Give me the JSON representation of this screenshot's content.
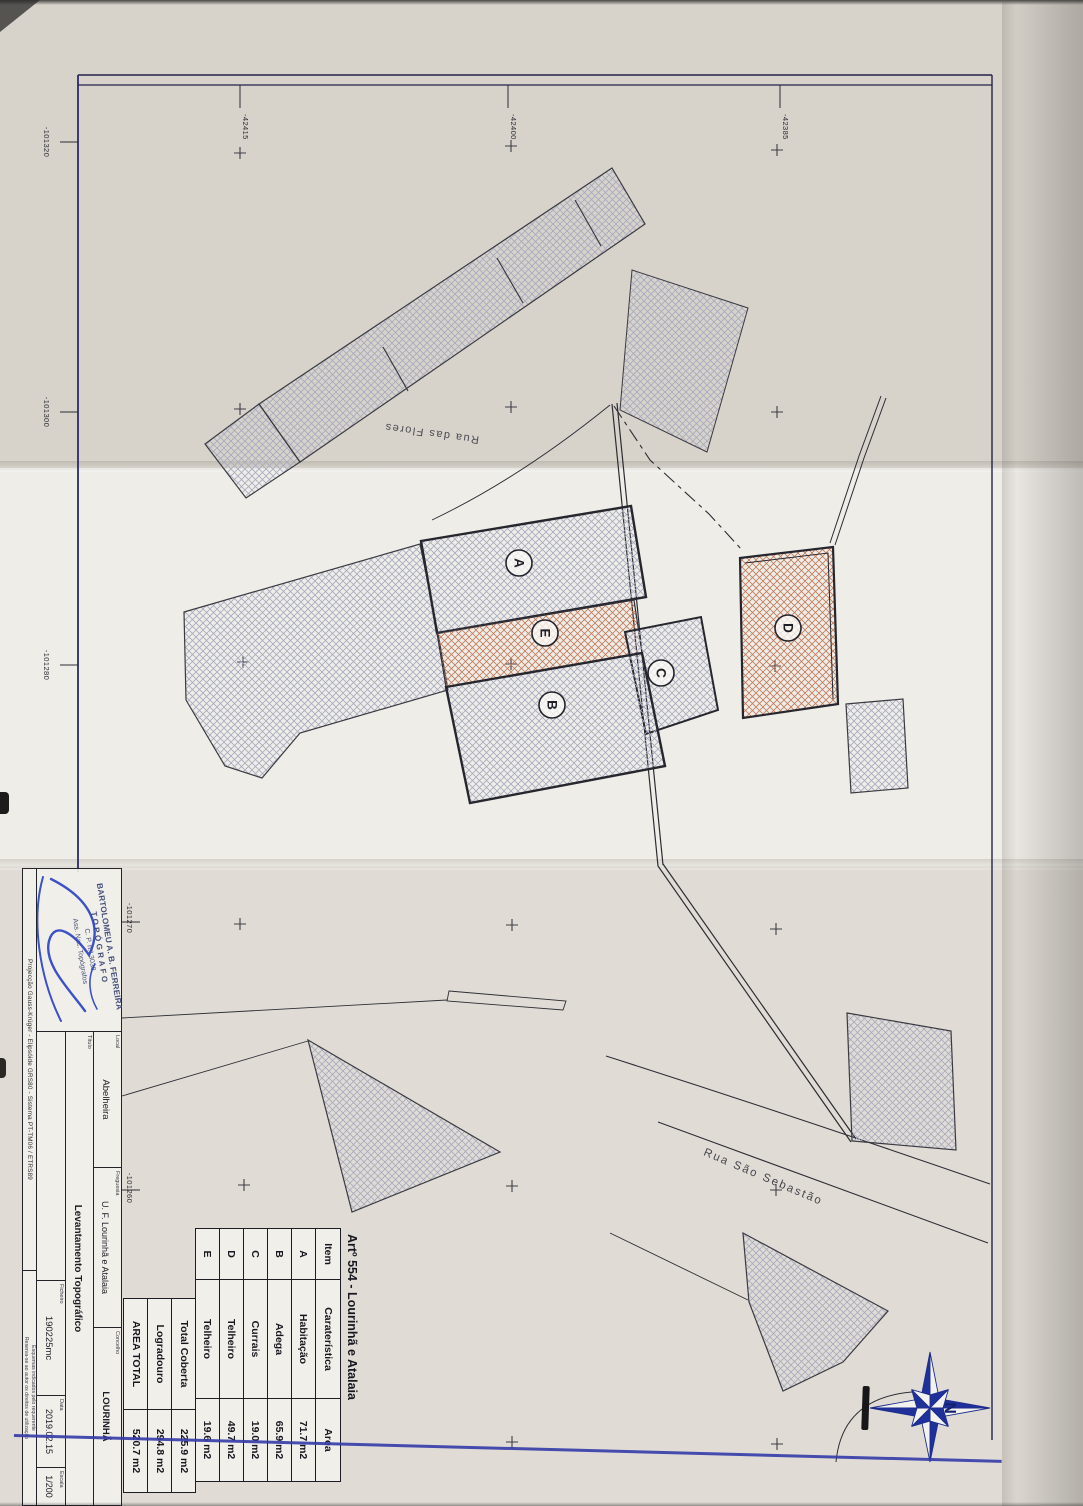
{
  "plan": {
    "title": "Artº 554 - Lourinhã e Atalaia",
    "streets": {
      "flores": "Rua das Flores",
      "sebastiao": "Rua São Sebastão"
    },
    "buildings": {
      "a": "A",
      "b": "B",
      "c": "C",
      "d": "D",
      "e": "E"
    },
    "grid": {
      "top": [
        "-42415",
        "-42400",
        "-42385"
      ],
      "left": [
        "-101320",
        "-101300",
        "-101280",
        "-101270",
        "-101260"
      ]
    },
    "compass_north": "N"
  },
  "area_table": {
    "headers": [
      "Item",
      "Caraterística",
      "Area"
    ],
    "rows": [
      [
        "A",
        "Habitação",
        "71.7 m2"
      ],
      [
        "B",
        "Adega",
        "65.9 m2"
      ],
      [
        "C",
        "Currais",
        "19.0 m2"
      ],
      [
        "D",
        "Telheiro",
        "49.7 m2"
      ],
      [
        "E",
        "Telheiro",
        "19.6 m2"
      ]
    ],
    "summary": [
      [
        "Total Coberta",
        "225.9 m2"
      ],
      [
        "Logradouro",
        "294.8 m2"
      ],
      [
        "AREA TOTAL",
        "520.7 m2"
      ]
    ]
  },
  "title_block": {
    "stamp": [
      "BARTOLOMEU A. B. FERREIRA",
      "TOPÓGRAFO",
      "C. P. n.º 3038",
      "Ass. Nac. Topógrafos"
    ],
    "projection": "Projecção Gauss-Krüger - Elipsóide GRS80 - Sistema PT-TM06 / ETRS89",
    "notes": [
      "Esquemas indicados pelo requerente",
      "Reserva-se ao autor os direitos de utilização"
    ],
    "local": {
      "label": "Local",
      "value": "Abelheira"
    },
    "freguesia": {
      "label": "Freguesia",
      "value": "U. F. Lourinhã e Atalaia"
    },
    "concelho": {
      "label": "Concelho",
      "value": "LOURINHÃ"
    },
    "titulo": {
      "label": "Título",
      "value": "Levantamento Topográfico"
    },
    "ficheiro": {
      "label": "Ficheiro",
      "value": "190225mc"
    },
    "data": {
      "label": "Data",
      "value": "2019.02.15"
    },
    "escala": {
      "label": "Escala",
      "value": "1/200"
    }
  }
}
